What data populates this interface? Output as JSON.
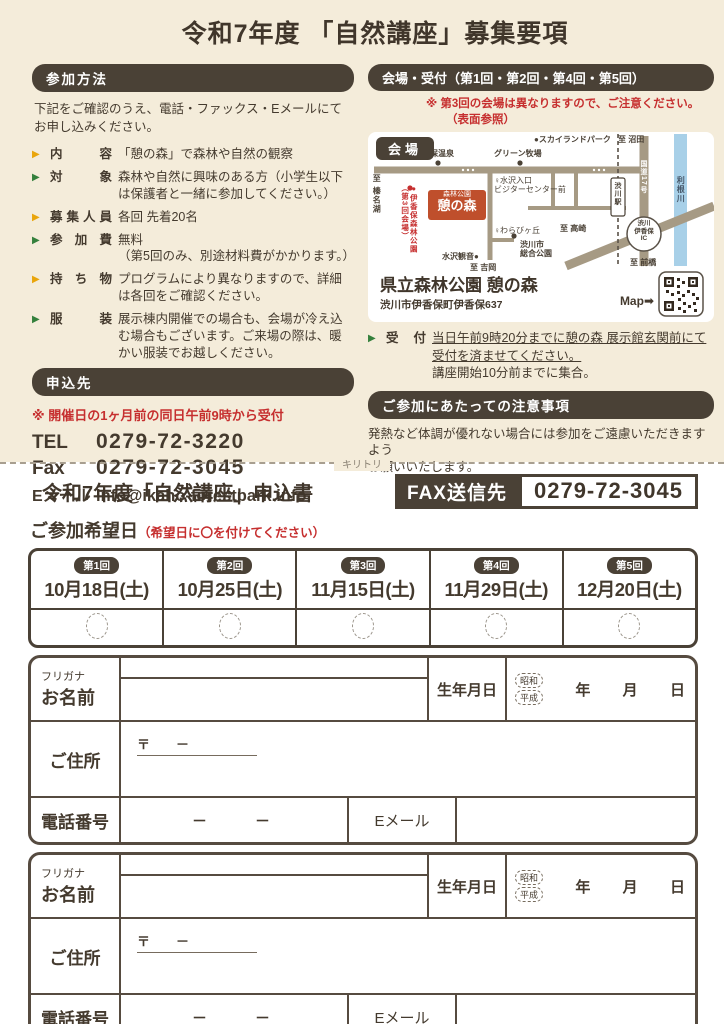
{
  "page": {
    "title": "令和7年度 「自然講座」募集要項"
  },
  "colors": {
    "beige_bg": "#f4ecda",
    "dark_brown": "#4a4136",
    "accent_red": "#c62f2f",
    "arrow_yellow": "#e9a50a",
    "arrow_green": "#34803c",
    "map_road": "#a69a84",
    "map_river": "#a8d0e8",
    "venue_box_red": "#bf4f2c"
  },
  "method": {
    "header": "参加方法",
    "intro": "下記をご確認のうえ、電話・ファックス・Eメールにて\nお申し込みください。",
    "items": [
      {
        "label": "内容",
        "text": "「憩の森」で森林や自然の観察"
      },
      {
        "label": "対象",
        "text": "森林や自然に興味のある方（小学生以下は保護者と一緒に参加してください。）"
      },
      {
        "label": "募集人員",
        "text": "各回 先着20名"
      },
      {
        "label": "参加費",
        "text": "無料\n（第5回のみ、別途材料費がかかります。）"
      },
      {
        "label": "持ち物",
        "text": "プログラムにより異なりますので、詳細は各回をご確認ください。"
      },
      {
        "label": "服装",
        "text": "展示棟内開催での場合も、会場が冷え込む場合もございます。ご来場の際は、暖かい服装でお越しください。"
      }
    ]
  },
  "apply_to": {
    "header": "申込先",
    "note": "※ 開催日の1ヶ月前の同日午前9時から受付",
    "tel_label": "TEL",
    "tel": "0279-72-3220",
    "fax_label": "Fax",
    "fax": "0279-72-3045",
    "email_label": "Eメール",
    "email": "info@ikaho-forestpark.info"
  },
  "venue": {
    "header": "会場・受付（第1回・第2回・第4回・第5回）",
    "note_line1": "※ 第3回の会場は異なりますので、ご注意ください。",
    "note_line2": "（表面参照）",
    "map_badge": "会場",
    "name": "県立森林公園 憩の森",
    "address": "渋川市伊香保町伊香保637",
    "map_pointer": "Map➡",
    "reception_label": "受付",
    "reception_underlined": "当日午前9時20分までに憩の森 展示館玄関前にて受付を済ませてください。",
    "reception_plain": "講座開始10分前までに集合。"
  },
  "caution": {
    "header": "ご参加にあたっての注意事項",
    "text": "発熱など体調が優れない場合には参加をご遠慮いただきますよう\nお願いいたします。"
  },
  "map": {
    "ikoi_top": "森林公園",
    "ikoi_main": "憩の森",
    "labels": [
      "至 榛名湖",
      "伊香保温泉",
      "グリーン牧場",
      "●スカイランドパーク",
      "至 沼田",
      "♀水沢入口\nビジターセンター前",
      "●伊香保森林公園\n（第3回会場）",
      "♀わらびヶ丘",
      "渋川市\n総合公園",
      "水沢観音●",
      "至 吉岡",
      "至 高崎",
      "渋川駅",
      "国道17号",
      "利根川",
      "渋川\n伊香保\nIC",
      "関越自動車道",
      "至 前橋"
    ]
  },
  "cutline": {
    "label": "キリトリ"
  },
  "apply": {
    "title": "令和7年度「自然講座」申込書",
    "fax_label": "FAX送信先",
    "fax_number": "0279-72-3045",
    "date_heading": "ご参加希望日",
    "date_heading_note": "（希望日に〇を付けてください）",
    "sessions": [
      {
        "round": "第1回",
        "date": "10月18日(土)"
      },
      {
        "round": "第2回",
        "date": "10月25日(土)"
      },
      {
        "round": "第3回",
        "date": "11月15日(土)"
      },
      {
        "round": "第4回",
        "date": "11月29日(土)"
      },
      {
        "round": "第5回",
        "date": "12月20日(土)"
      }
    ]
  },
  "form": {
    "furigana_label": "フリガナ",
    "name_label": "お名前",
    "birth_label": "生年月日",
    "era1": "昭和",
    "era2": "平成",
    "year_label": "年",
    "month_label": "月",
    "day_label": "日",
    "address_label": "ご住所",
    "postal_line": "〒　　－",
    "phone_label": "電話番号",
    "phone_dashes": "－　　－",
    "email_label": "Eメール"
  }
}
